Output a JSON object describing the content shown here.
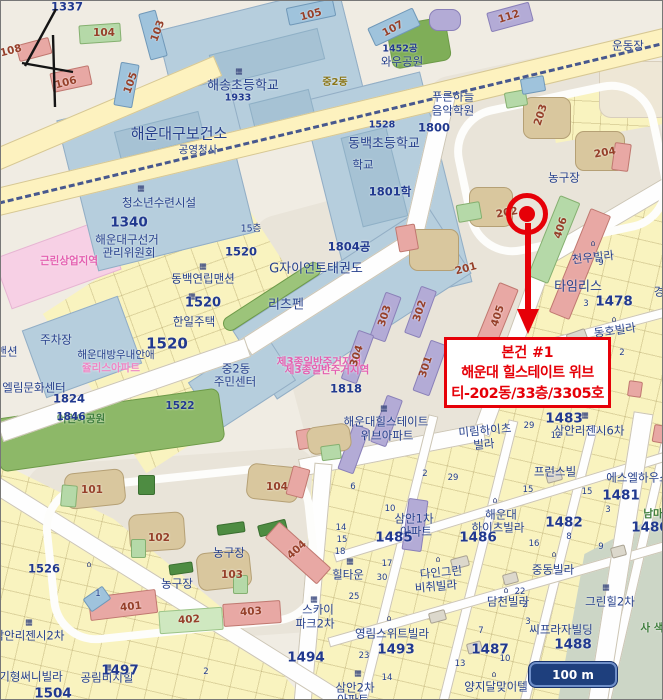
{
  "page_marker": "4",
  "scale_bar": {
    "label": "100 m"
  },
  "annotation": {
    "title": "본건 #1",
    "building": "해운대 힐스테이트 위브",
    "unit": "티-202동/33층/3305호"
  },
  "icons": {
    "building": "▦",
    "house": "⌂"
  },
  "colors": {
    "annotation_red": "#e60008",
    "label_navy": "#26408c",
    "building_number_brown": "#96402a",
    "zone_pink_text": "#e45fb0",
    "park_green_text": "#3e7d3c",
    "school_block_blue": "#b6cedd",
    "parcel_yellow": "#f9f3bf",
    "park_green": "#86b05c",
    "scalebar_blue": "#1e3f7d"
  },
  "labels": [
    {
      "t": "1337"
    },
    {
      "t": "104"
    },
    {
      "t": "103"
    },
    {
      "t": "108"
    },
    {
      "t": "106"
    },
    {
      "t": "105"
    },
    {
      "t": "105"
    },
    {
      "t": "107"
    },
    {
      "t": "112"
    },
    {
      "t": "운동장"
    },
    {
      "t": "해송초등학교"
    },
    {
      "t": "1933"
    },
    {
      "t": "중2동"
    },
    {
      "t": "1452공"
    },
    {
      "t": "와우공원"
    },
    {
      "t": "푸른하늘"
    },
    {
      "t": "음악학원"
    },
    {
      "t": "1800"
    },
    {
      "t": "1528"
    },
    {
      "t": "동백초등학교"
    },
    {
      "t": "학교"
    },
    {
      "t": "1801학"
    },
    {
      "t": "해운대구보건소"
    },
    {
      "t": "공영청사"
    },
    {
      "t": "청소년수련시설"
    },
    {
      "t": "1340"
    },
    {
      "t": "해운대구선거"
    },
    {
      "t": "관리위원회"
    },
    {
      "t": "근린상업지역"
    },
    {
      "t": "1520"
    },
    {
      "t": "동백연립맨션"
    },
    {
      "t": "1520"
    },
    {
      "t": "한일주택"
    },
    {
      "t": "1520"
    },
    {
      "t": "G자이언트태권도"
    },
    {
      "t": "리츠펜"
    },
    {
      "t": "1804공"
    },
    {
      "t": "주차장"
    },
    {
      "t": "맨션"
    },
    {
      "t": "해운대방우내안애"
    },
    {
      "t": "쥴리스아파트"
    },
    {
      "t": "엘림문화센터"
    },
    {
      "t": "1824"
    },
    {
      "t": "어린이공원"
    },
    {
      "t": "1846"
    },
    {
      "t": "1522"
    },
    {
      "t": "중2동"
    },
    {
      "t": "주민센터"
    },
    {
      "t": "제3종일반주거지역"
    },
    {
      "t": "제3종일반주거지역"
    },
    {
      "t": "1818"
    },
    {
      "t": "303"
    },
    {
      "t": "302"
    },
    {
      "t": "304"
    },
    {
      "t": "301"
    },
    {
      "t": "201"
    },
    {
      "t": "202"
    },
    {
      "t": "203"
    },
    {
      "t": "204"
    },
    {
      "t": "405"
    },
    {
      "t": "406"
    },
    {
      "t": "농구장"
    },
    {
      "t": "천우빌라"
    },
    {
      "t": "타임리스"
    },
    {
      "t": "1478"
    },
    {
      "t": "경"
    },
    {
      "t": "동호빌라"
    },
    {
      "t": "미림하이츠"
    },
    {
      "t": "빌라"
    },
    {
      "t": "해운대힐스테이트"
    },
    {
      "t": "위브아파트"
    },
    {
      "t": "1483"
    },
    {
      "t": "삼안리젠시6차"
    },
    {
      "t": "프런스빌"
    },
    {
      "t": "에스엘하우스"
    },
    {
      "t": "1481"
    },
    {
      "t": "1482"
    },
    {
      "t": "남마"
    },
    {
      "t": "1480"
    },
    {
      "t": "해운대"
    },
    {
      "t": "하이츠빌라"
    },
    {
      "t": "1486"
    },
    {
      "t": "삼안1차"
    },
    {
      "t": "아파트"
    },
    {
      "t": "1485"
    },
    {
      "t": "힐타운"
    },
    {
      "t": "다인그린"
    },
    {
      "t": "비취빌라"
    },
    {
      "t": "담천빌라"
    },
    {
      "t": "중동빌라"
    },
    {
      "t": "그린힐2차"
    },
    {
      "t": "씨프라자빌딩"
    },
    {
      "t": "1488"
    },
    {
      "t": "사 색"
    },
    {
      "t": "영림스위트빌라"
    },
    {
      "t": "1493"
    },
    {
      "t": "1487"
    },
    {
      "t": "양지달맞이텔"
    },
    {
      "t": "삼안2차"
    },
    {
      "t": "아파트"
    },
    {
      "t": "1526"
    },
    {
      "t": "삼안리젠시2차"
    },
    {
      "t": "기형써니빌라"
    },
    {
      "t": "공림비치힐"
    },
    {
      "t": "1497"
    },
    {
      "t": "1504"
    },
    {
      "t": "농구장"
    },
    {
      "t": "농구장"
    },
    {
      "t": "101"
    },
    {
      "t": "102"
    },
    {
      "t": "103"
    },
    {
      "t": "104"
    },
    {
      "t": "401"
    },
    {
      "t": "402"
    },
    {
      "t": "403"
    },
    {
      "t": "404"
    },
    {
      "t": "스카이"
    },
    {
      "t": "파크2차"
    },
    {
      "t": "1494"
    },
    {
      "t": "15층"
    },
    {
      "t": "6"
    },
    {
      "t": "2"
    },
    {
      "t": "29"
    },
    {
      "t": "15"
    },
    {
      "t": "15"
    },
    {
      "t": "3"
    },
    {
      "t": "10"
    },
    {
      "t": "14"
    },
    {
      "t": "15"
    },
    {
      "t": "18"
    },
    {
      "t": "8"
    },
    {
      "t": "16"
    },
    {
      "t": "9"
    },
    {
      "t": "17"
    },
    {
      "t": "30"
    },
    {
      "t": "25"
    },
    {
      "t": "22"
    },
    {
      "t": "2"
    },
    {
      "t": "3"
    },
    {
      "t": "13"
    },
    {
      "t": "10"
    },
    {
      "t": "14"
    },
    {
      "t": "7"
    },
    {
      "t": "1"
    },
    {
      "t": "2"
    },
    {
      "t": "9"
    },
    {
      "t": "3"
    },
    {
      "t": "2"
    },
    {
      "t": "23"
    },
    {
      "t": "12"
    },
    {
      "t": "29"
    }
  ]
}
